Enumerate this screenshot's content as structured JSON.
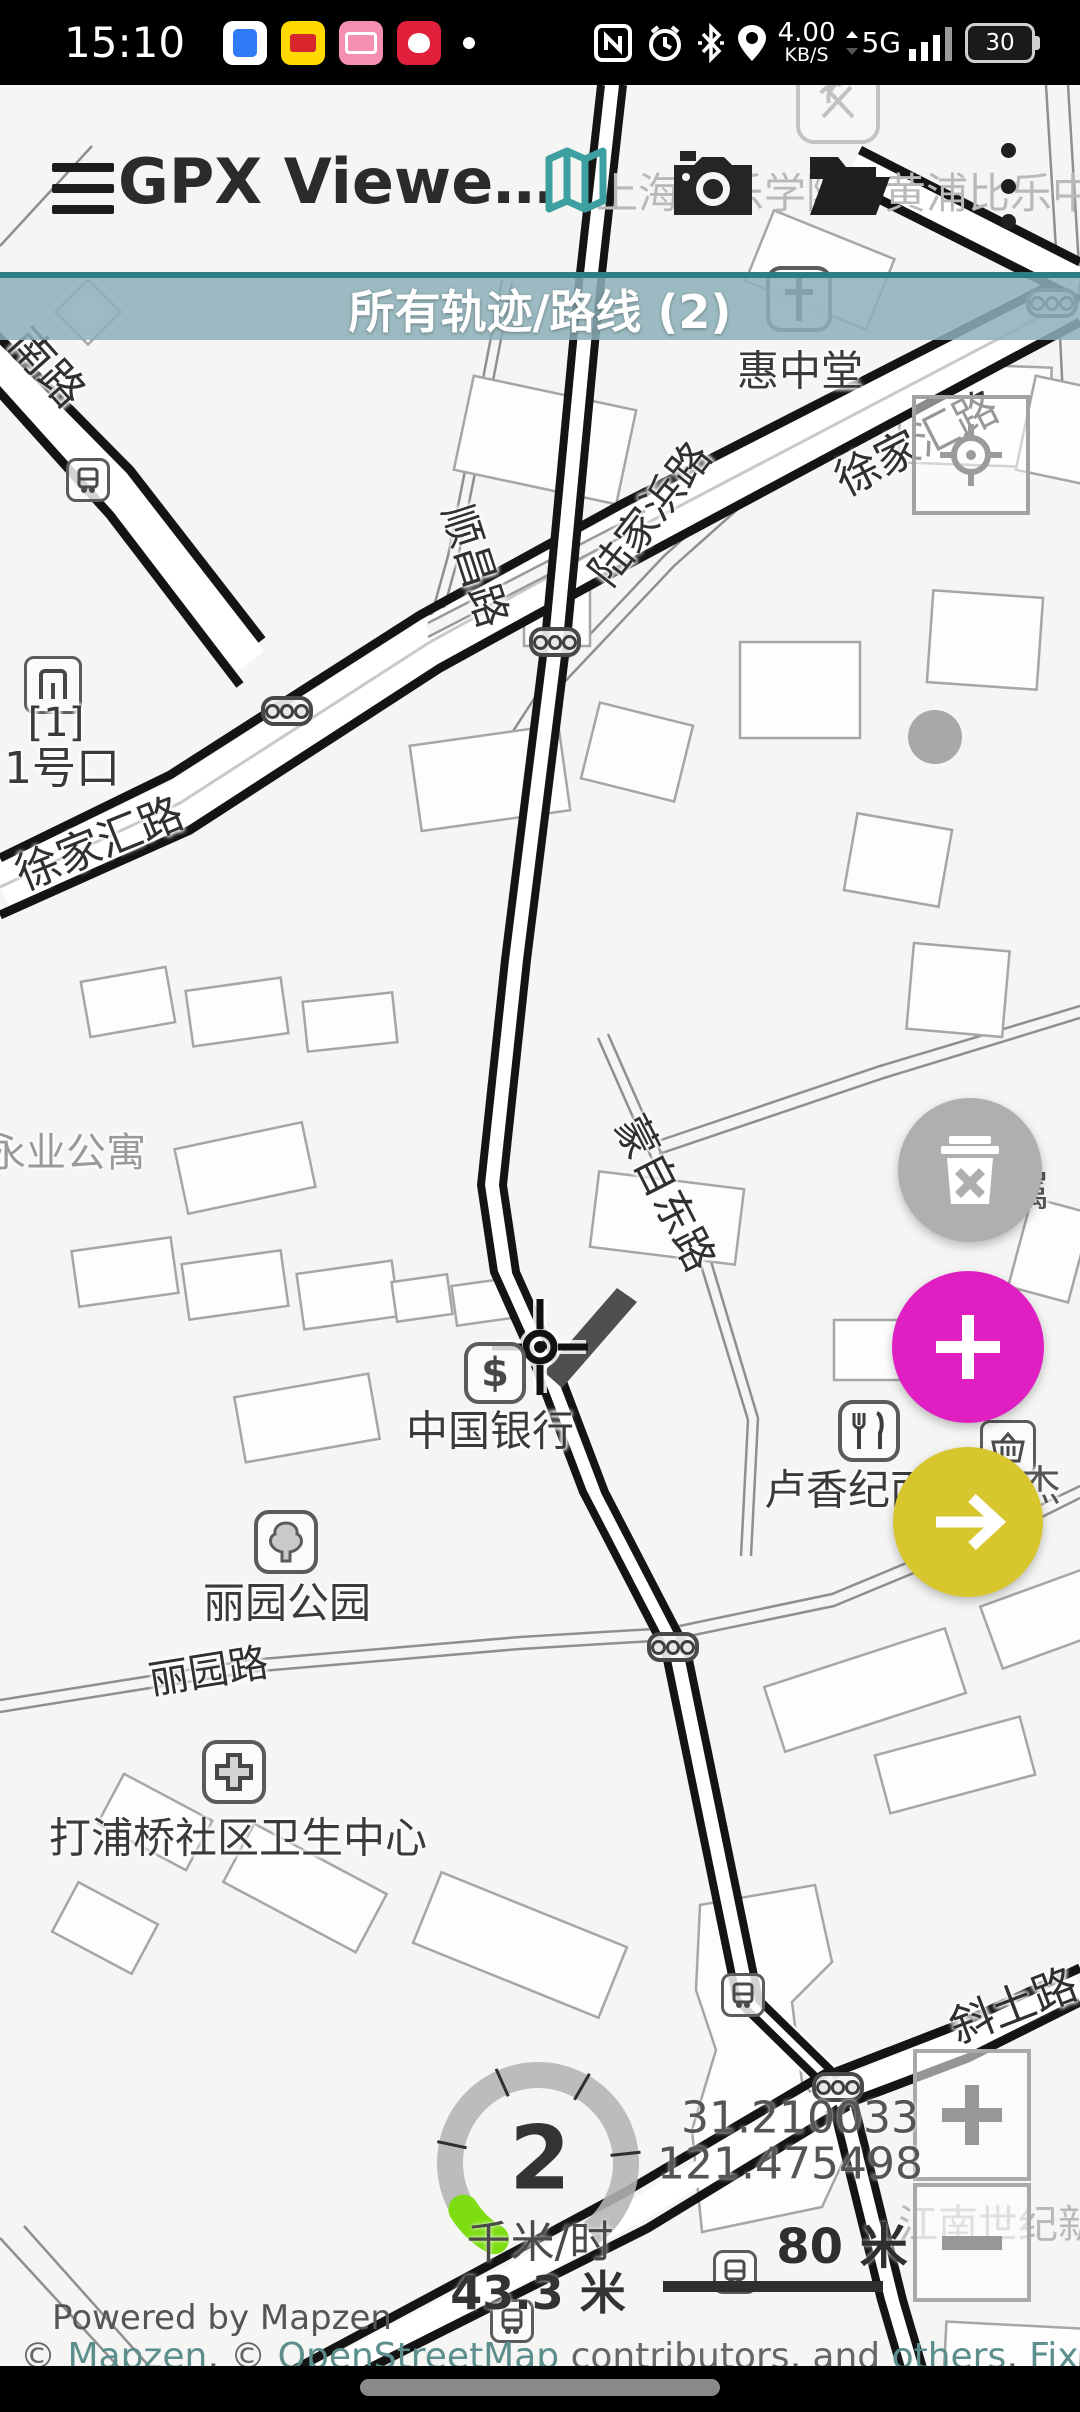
{
  "status_bar": {
    "time": "15:10",
    "net_speed": "4.00",
    "net_unit": "KB/S",
    "net_type": "5G",
    "battery": "30"
  },
  "toolbar": {
    "title": "GPX Viewe…"
  },
  "banner": {
    "text": "所有轨迹/路线 (2)"
  },
  "map": {
    "streets": {
      "xujiahui_right": "徐家汇路",
      "xujiahui_left": "徐家汇路",
      "lujiabang": "陆家浜路",
      "shunchang": "顺昌路",
      "nanlu_partial": "南路",
      "mengzidong": "蒙自东路",
      "liyuan_road": "丽园路",
      "xietu": "斜土路"
    },
    "pois": {
      "church": "惠中堂",
      "exit_number": "[1]",
      "exit_name": "1号口",
      "bank": "中国银行",
      "park": "丽园公园",
      "health_center": "打浦桥社区卫生中心",
      "noodle_shop": "卢香纪面",
      "fushu_partial": "附属",
      "jie_partial": "杰",
      "apartment": "永业公寓",
      "jiangnan_partial": "江南世纪新",
      "school_left": "上海音乐学院",
      "school_right": "黄浦比乐中学"
    }
  },
  "hud": {
    "speed": "2",
    "speed_unit": "千米/时",
    "altitude": "43.3 米",
    "latitude": "31.210033",
    "longitude": "121.475498",
    "scale": "80 米"
  },
  "attribution": {
    "powered": "Powered by Mapzen",
    "prefix": "© ",
    "link_mapzen": "Mapzen",
    "sep1": ", © ",
    "link_osm": "OpenStreetMap",
    "mid": " contributors, and ",
    "link_others": "others",
    "sep2": ", ",
    "link_fix": "Fix the map"
  },
  "colors": {
    "banner_teal": "#8cb0b8",
    "banner_border": "#2e7d86",
    "fab_delete": "#b1aeae",
    "fab_add": "#e01fc2",
    "fab_navigate": "#d8c62f",
    "gauge_green": "#7ddd12",
    "map_icon_teal": "#3d9fa0",
    "link_teal": "#5b8e8c"
  }
}
